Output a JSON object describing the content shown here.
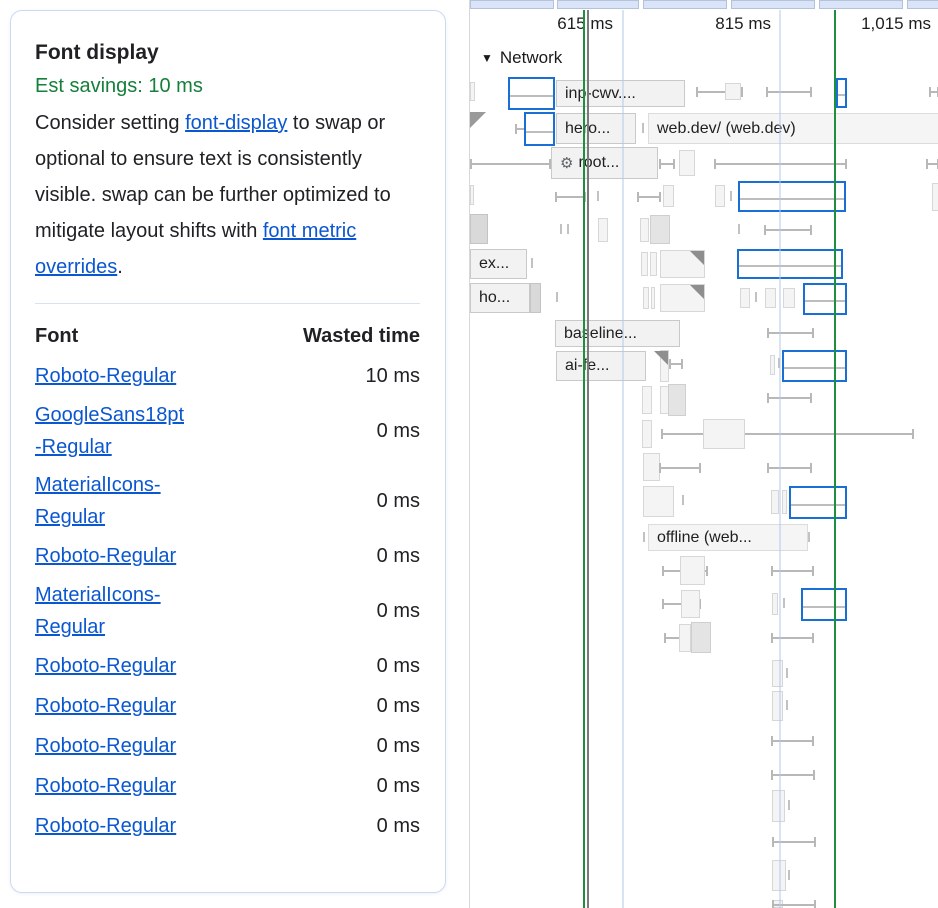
{
  "insight": {
    "title": "Font display",
    "savings": "Est savings: 10 ms",
    "description": [
      {
        "text": "Consider setting "
      },
      {
        "link": "font-display"
      },
      {
        "text": " to swap or optional to ensure text is consistently visible. swap can be further optimized to mitigate layout shifts with "
      },
      {
        "link": "font metric overrides"
      },
      {
        "text": "."
      }
    ],
    "table": {
      "headers": [
        "Font",
        "Wasted time"
      ],
      "rows": [
        {
          "font": "Roboto-Regular",
          "time": "10 ms"
        },
        {
          "font": "GoogleSans18pt\n-Regular",
          "time": "0 ms"
        },
        {
          "font": "MaterialIcons-\nRegular",
          "time": "0 ms"
        },
        {
          "font": "Roboto-Regular",
          "time": "0 ms"
        },
        {
          "font": "MaterialIcons-\nRegular",
          "time": "0 ms"
        },
        {
          "font": "Roboto-Regular",
          "time": "0 ms"
        },
        {
          "font": "Roboto-Regular",
          "time": "0 ms"
        },
        {
          "font": "Roboto-Regular",
          "time": "0 ms"
        },
        {
          "font": "Roboto-Regular",
          "time": "0 ms"
        },
        {
          "font": "Roboto-Regular",
          "time": "0 ms"
        }
      ]
    }
  },
  "timeline": {
    "network_label": "Network",
    "collapse_icon": "▼",
    "gear_icon": "⚙",
    "ruler": [
      {
        "label": "615 ms",
        "right": 143
      },
      {
        "label": "815 ms",
        "right": 301
      },
      {
        "label": "1,015 ms",
        "right": 461
      }
    ],
    "top_strip": [
      [
        0,
        84
      ],
      [
        87,
        82
      ],
      [
        173,
        84
      ],
      [
        261,
        84
      ],
      [
        349,
        84
      ],
      [
        437,
        32
      ]
    ],
    "gridlines": [
      152,
      309
    ],
    "markers": [
      {
        "x": 113,
        "color": "green"
      },
      {
        "x": 117,
        "color": "grey"
      },
      {
        "x": 364,
        "color": "green"
      }
    ],
    "items": [
      {
        "t": "bar",
        "x": 0,
        "y": 82,
        "w": 5,
        "h": 19
      },
      {
        "t": "wh",
        "x1": 227,
        "x2": 272,
        "y": 91
      },
      {
        "t": "bar",
        "x": 255,
        "y": 83,
        "w": 16,
        "h": 17
      },
      {
        "t": "wh",
        "x1": 297,
        "x2": 341,
        "y": 91
      },
      {
        "t": "wh",
        "x1": 460,
        "x2": 468,
        "y": 91
      },
      {
        "t": "sel",
        "x": 38,
        "y": 77,
        "w": 47,
        "h": 33
      },
      {
        "t": "label",
        "x": 86,
        "y": 80,
        "w": 129,
        "h": 27,
        "text": "inp-cwv...."
      },
      {
        "t": "sel",
        "x": 366,
        "y": 78,
        "w": 11,
        "h": 30
      },
      {
        "t": "corner",
        "x": 0,
        "y": 112
      },
      {
        "t": "wh",
        "x1": 46,
        "x2": 56,
        "y": 128
      },
      {
        "t": "sel",
        "x": 54,
        "y": 112,
        "w": 31,
        "h": 34
      },
      {
        "t": "label",
        "x": 86,
        "y": 113,
        "w": 80,
        "h": 31,
        "text": "hero..."
      },
      {
        "t": "tick",
        "x": 172,
        "y": 123
      },
      {
        "t": "label",
        "x": 178,
        "y": 113,
        "w": 291,
        "h": 31,
        "text": "web.dev/ (web.dev)",
        "cls": "wide"
      },
      {
        "t": "wh",
        "x1": 1,
        "x2": 80,
        "y": 163
      },
      {
        "t": "label",
        "x": 81,
        "y": 147,
        "w": 107,
        "h": 32,
        "text": "root...",
        "icon": true
      },
      {
        "t": "wh",
        "x1": 190,
        "x2": 204,
        "y": 163
      },
      {
        "t": "bar",
        "x": 209,
        "y": 150,
        "w": 16,
        "h": 26
      },
      {
        "t": "wh",
        "x1": 245,
        "x2": 376,
        "y": 163
      },
      {
        "t": "wh",
        "x1": 457,
        "x2": 468,
        "y": 163
      },
      {
        "t": "bar",
        "x": 0,
        "y": 185,
        "w": 4,
        "h": 20
      },
      {
        "t": "wh",
        "x1": 86,
        "x2": 115,
        "y": 196
      },
      {
        "t": "tick",
        "x": 127,
        "y": 191
      },
      {
        "t": "wh",
        "x1": 168,
        "x2": 190,
        "y": 196
      },
      {
        "t": "bar",
        "x": 193,
        "y": 185,
        "w": 11,
        "h": 22
      },
      {
        "t": "bar",
        "x": 245,
        "y": 185,
        "w": 10,
        "h": 22
      },
      {
        "t": "tick",
        "x": 260,
        "y": 191
      },
      {
        "t": "sel",
        "x": 268,
        "y": 181,
        "w": 108,
        "h": 31
      },
      {
        "t": "bar",
        "x": 462,
        "y": 183,
        "w": 7,
        "h": 28
      },
      {
        "t": "bar",
        "x": 0,
        "y": 214,
        "w": 18,
        "h": 30,
        "f": "dark"
      },
      {
        "t": "tick",
        "x": 90,
        "y": 224
      },
      {
        "t": "tick",
        "x": 97,
        "y": 224
      },
      {
        "t": "bar",
        "x": 128,
        "y": 218,
        "w": 10,
        "h": 24
      },
      {
        "t": "bar",
        "x": 170,
        "y": 218,
        "w": 9,
        "h": 24
      },
      {
        "t": "bar",
        "x": 180,
        "y": 215,
        "w": 20,
        "h": 29,
        "f": "mid"
      },
      {
        "t": "tick",
        "x": 268,
        "y": 224
      },
      {
        "t": "wh",
        "x1": 295,
        "x2": 341,
        "y": 229
      },
      {
        "t": "label",
        "x": 0,
        "y": 249,
        "w": 57,
        "h": 30,
        "text": "ex..."
      },
      {
        "t": "tick",
        "x": 61,
        "y": 258
      },
      {
        "t": "bar",
        "x": 171,
        "y": 252,
        "w": 7,
        "h": 24
      },
      {
        "t": "bar",
        "x": 180,
        "y": 252,
        "w": 7,
        "h": 24
      },
      {
        "t": "bar",
        "x": 190,
        "y": 250,
        "w": 45,
        "h": 28,
        "tri": true
      },
      {
        "t": "sel",
        "x": 267,
        "y": 249,
        "w": 106,
        "h": 30
      },
      {
        "t": "label",
        "x": 0,
        "y": 283,
        "w": 60,
        "h": 30,
        "text": "ho..."
      },
      {
        "t": "bar",
        "x": 60,
        "y": 283,
        "w": 11,
        "h": 30,
        "f": "dark"
      },
      {
        "t": "tick",
        "x": 86,
        "y": 292
      },
      {
        "t": "bar",
        "x": 173,
        "y": 287,
        "w": 6,
        "h": 22
      },
      {
        "t": "bar",
        "x": 181,
        "y": 287,
        "w": 4,
        "h": 22
      },
      {
        "t": "bar",
        "x": 190,
        "y": 284,
        "w": 45,
        "h": 28,
        "tri": true
      },
      {
        "t": "bar",
        "x": 270,
        "y": 288,
        "w": 10,
        "h": 20
      },
      {
        "t": "tick",
        "x": 285,
        "y": 292
      },
      {
        "t": "bar",
        "x": 295,
        "y": 288,
        "w": 11,
        "h": 20
      },
      {
        "t": "bar",
        "x": 313,
        "y": 288,
        "w": 12,
        "h": 20
      },
      {
        "t": "sel",
        "x": 333,
        "y": 283,
        "w": 44,
        "h": 32
      },
      {
        "t": "label",
        "x": 85,
        "y": 320,
        "w": 125,
        "h": 27,
        "text": "baseline..."
      },
      {
        "t": "wh",
        "x1": 298,
        "x2": 343,
        "y": 332
      },
      {
        "t": "label",
        "x": 86,
        "y": 351,
        "w": 90,
        "h": 30,
        "text": "ai-fe..."
      },
      {
        "t": "bar",
        "x": 190,
        "y": 350,
        "w": 9,
        "h": 32,
        "tri": true
      },
      {
        "t": "wh",
        "x1": 200,
        "x2": 212,
        "y": 363
      },
      {
        "t": "bar",
        "x": 300,
        "y": 355,
        "w": 5,
        "h": 20
      },
      {
        "t": "tick",
        "x": 308,
        "y": 358
      },
      {
        "t": "sel",
        "x": 312,
        "y": 350,
        "w": 65,
        "h": 32
      },
      {
        "t": "bar",
        "x": 172,
        "y": 386,
        "w": 10,
        "h": 28
      },
      {
        "t": "bar",
        "x": 190,
        "y": 386,
        "w": 9,
        "h": 28
      },
      {
        "t": "bar",
        "x": 198,
        "y": 384,
        "w": 18,
        "h": 32,
        "f": "mid"
      },
      {
        "t": "wh",
        "x1": 298,
        "x2": 341,
        "y": 397
      },
      {
        "t": "bar",
        "x": 172,
        "y": 420,
        "w": 10,
        "h": 28
      },
      {
        "t": "wh",
        "x1": 192,
        "x2": 443,
        "y": 433
      },
      {
        "t": "bar",
        "x": 233,
        "y": 419,
        "w": 42,
        "h": 30
      },
      {
        "t": "bar",
        "x": 173,
        "y": 453,
        "w": 17,
        "h": 28
      },
      {
        "t": "wh",
        "x1": 190,
        "x2": 230,
        "y": 467
      },
      {
        "t": "wh",
        "x1": 298,
        "x2": 341,
        "y": 467
      },
      {
        "t": "bar",
        "x": 173,
        "y": 486,
        "w": 31,
        "h": 31
      },
      {
        "t": "tick",
        "x": 212,
        "y": 495
      },
      {
        "t": "bar",
        "x": 301,
        "y": 490,
        "w": 8,
        "h": 24
      },
      {
        "t": "bar",
        "x": 312,
        "y": 490,
        "w": 5,
        "h": 24
      },
      {
        "t": "sel",
        "x": 319,
        "y": 486,
        "w": 58,
        "h": 33
      },
      {
        "t": "tick",
        "x": 173,
        "y": 532
      },
      {
        "t": "label",
        "x": 178,
        "y": 524,
        "w": 160,
        "h": 27,
        "text": "offline (web...",
        "cls": "wide"
      },
      {
        "t": "tick",
        "x": 338,
        "y": 532
      },
      {
        "t": "wh",
        "x1": 193,
        "x2": 237,
        "y": 570
      },
      {
        "t": "bar",
        "x": 210,
        "y": 556,
        "w": 25,
        "h": 29
      },
      {
        "t": "wh",
        "x1": 302,
        "x2": 343,
        "y": 570
      },
      {
        "t": "wh",
        "x1": 193,
        "x2": 230,
        "y": 603
      },
      {
        "t": "bar",
        "x": 211,
        "y": 590,
        "w": 19,
        "h": 28
      },
      {
        "t": "bar",
        "x": 302,
        "y": 593,
        "w": 6,
        "h": 22
      },
      {
        "t": "tick",
        "x": 313,
        "y": 598
      },
      {
        "t": "sel",
        "x": 331,
        "y": 588,
        "w": 46,
        "h": 33
      },
      {
        "t": "wh",
        "x1": 195,
        "x2": 240,
        "y": 637
      },
      {
        "t": "bar",
        "x": 209,
        "y": 624,
        "w": 12,
        "h": 28
      },
      {
        "t": "bar",
        "x": 221,
        "y": 622,
        "w": 20,
        "h": 31,
        "f": "mid"
      },
      {
        "t": "wh",
        "x1": 302,
        "x2": 343,
        "y": 637
      },
      {
        "t": "bar",
        "x": 302,
        "y": 660,
        "w": 11,
        "h": 27
      },
      {
        "t": "tick",
        "x": 316,
        "y": 668
      },
      {
        "t": "bar",
        "x": 302,
        "y": 691,
        "w": 11,
        "h": 30
      },
      {
        "t": "tick",
        "x": 316,
        "y": 700
      },
      {
        "t": "wh",
        "x1": 302,
        "x2": 343,
        "y": 740
      },
      {
        "t": "wh",
        "x1": 302,
        "x2": 344,
        "y": 774
      },
      {
        "t": "bar",
        "x": 302,
        "y": 790,
        "w": 13,
        "h": 32
      },
      {
        "t": "tick",
        "x": 318,
        "y": 800
      },
      {
        "t": "wh",
        "x1": 303,
        "x2": 345,
        "y": 841
      },
      {
        "t": "bar",
        "x": 302,
        "y": 860,
        "w": 14,
        "h": 31
      },
      {
        "t": "tick",
        "x": 318,
        "y": 870
      },
      {
        "t": "bar",
        "x": 303,
        "y": 900,
        "w": 10,
        "h": 8
      },
      {
        "t": "wh",
        "x1": 303,
        "x2": 345,
        "y": 904
      }
    ]
  }
}
